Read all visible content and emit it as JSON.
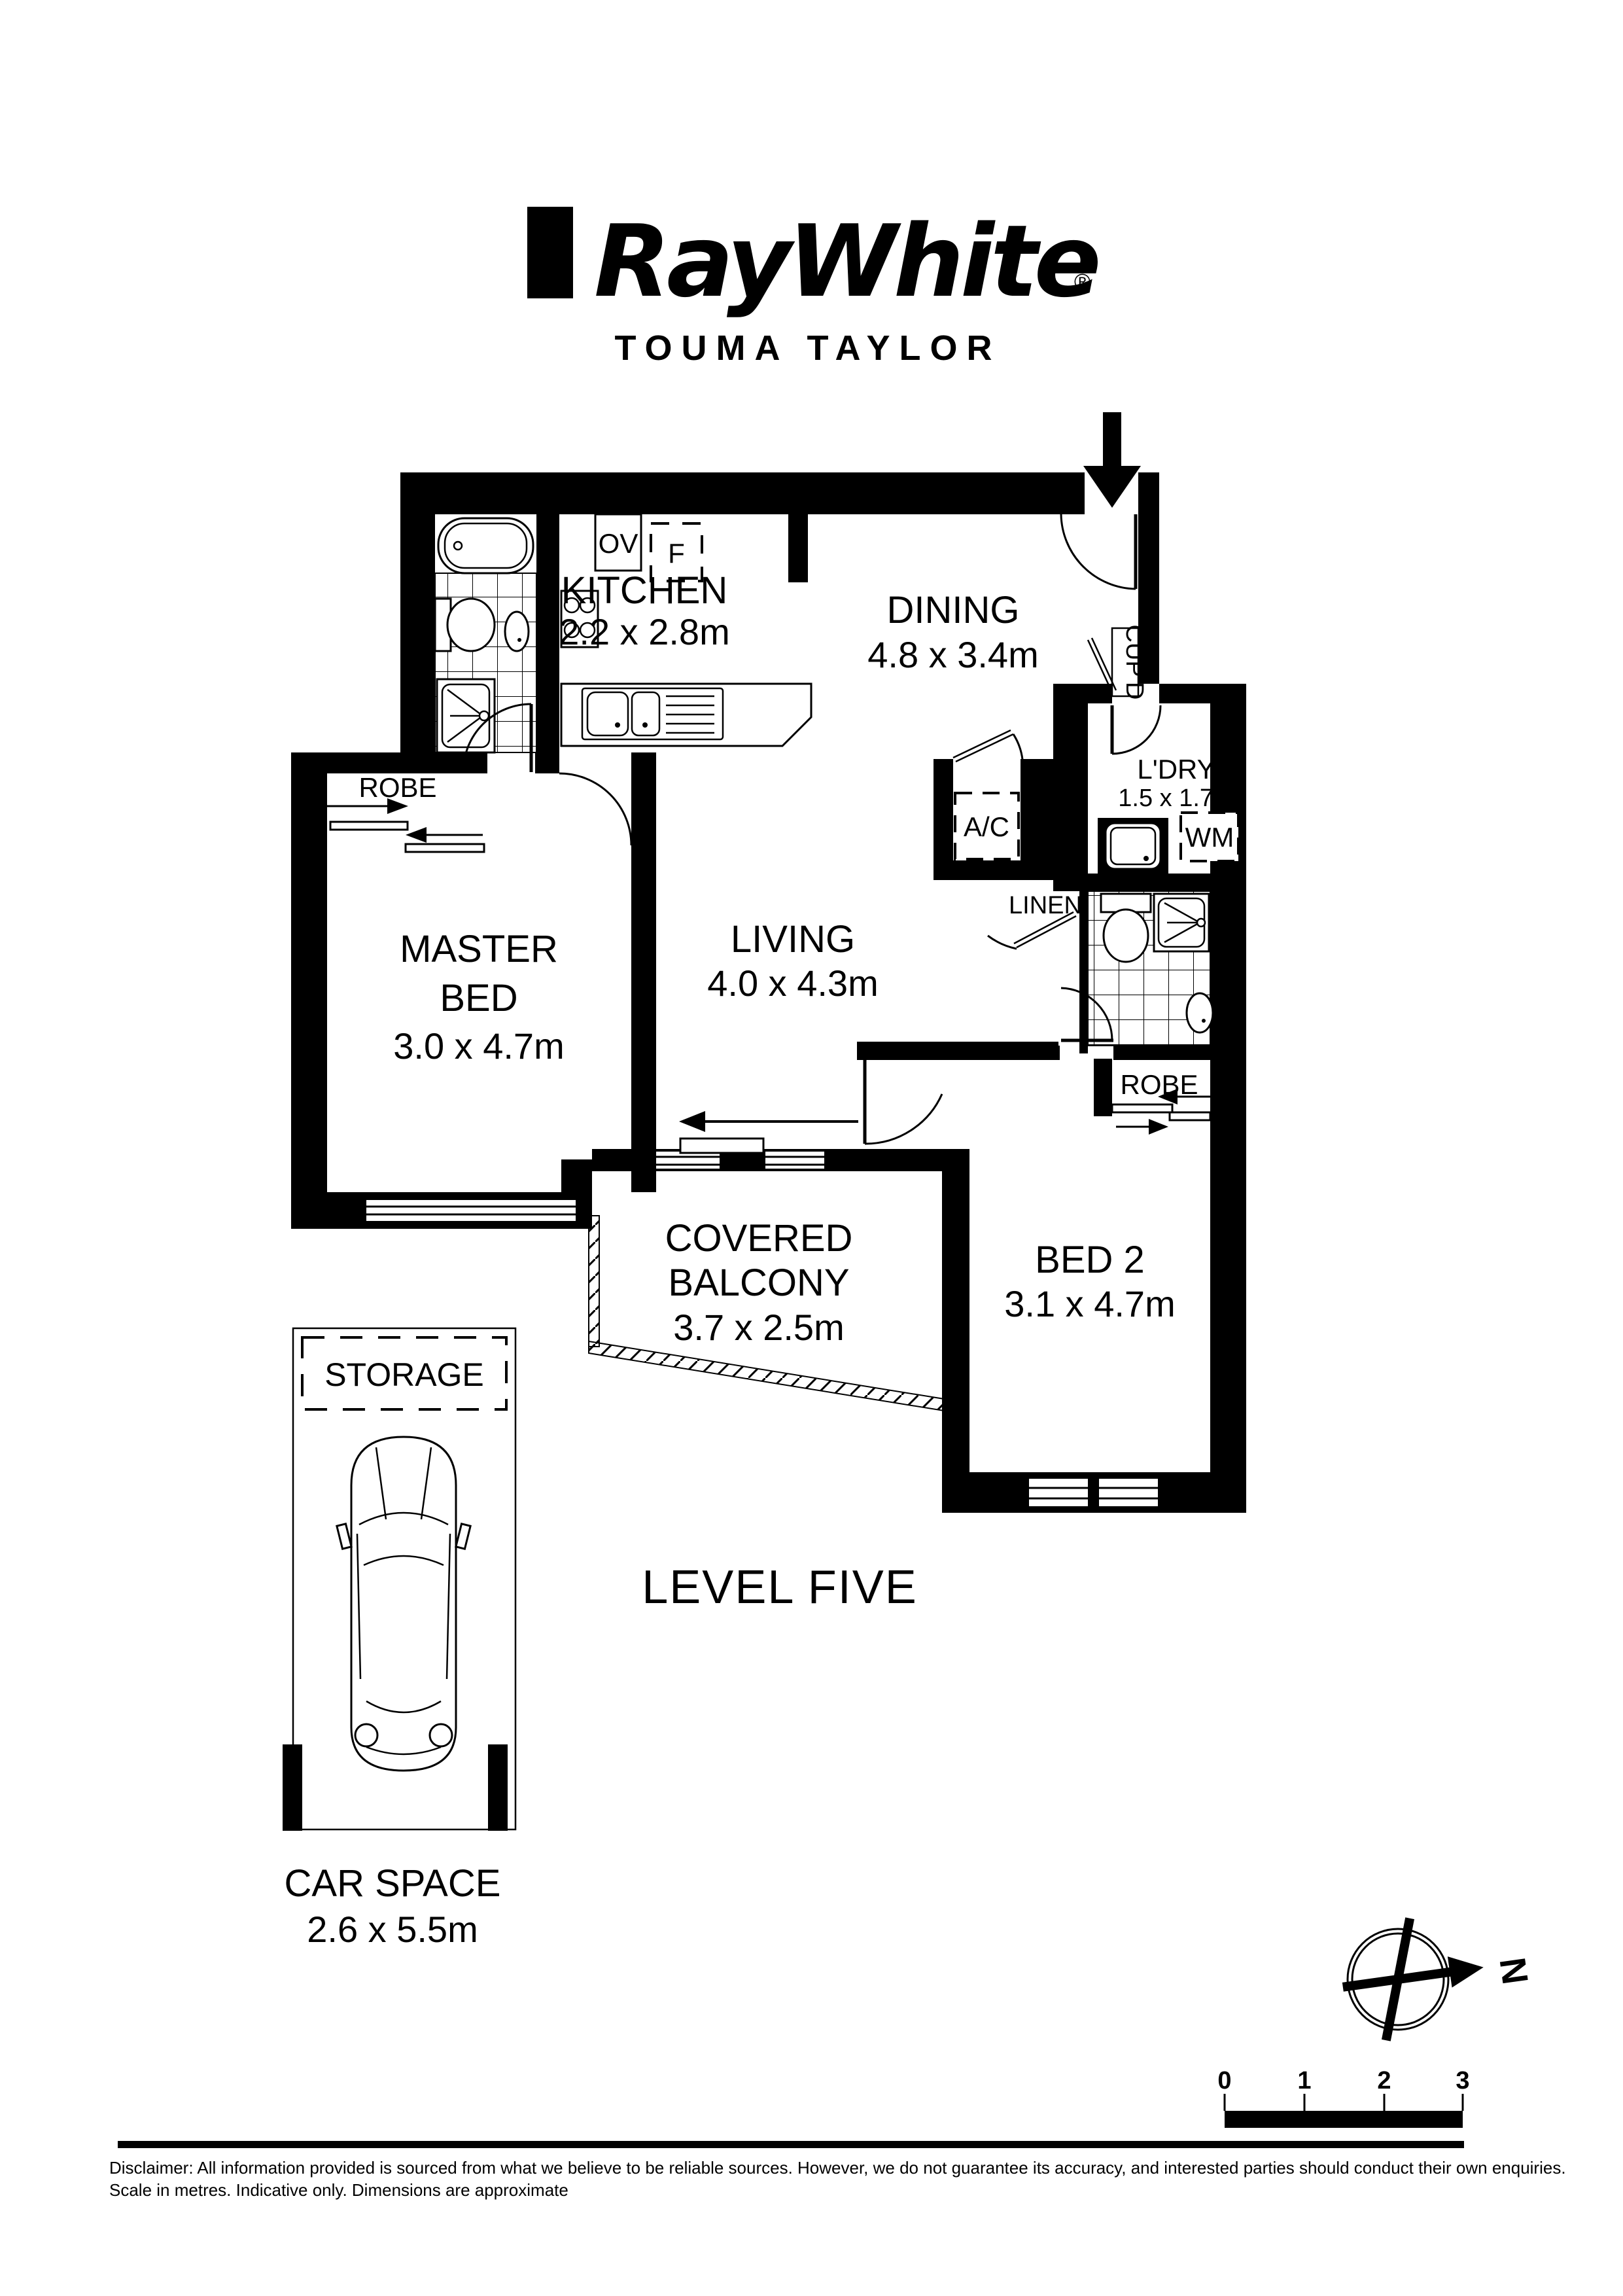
{
  "header": {
    "logo_text": "RayWhite",
    "registered_mark": "®",
    "office_name": "TOUMA TAYLOR"
  },
  "floorplan": {
    "rooms": {
      "kitchen": {
        "name": "KITCHEN",
        "dims": "2.2 x 2.8m"
      },
      "dining": {
        "name": "DINING",
        "dims": "4.8 x 3.4m"
      },
      "living": {
        "name": "LIVING",
        "dims": "4.0 x 4.3m"
      },
      "master_bed": {
        "name_line1": "MASTER",
        "name_line2": "BED",
        "dims": "3.0 x 4.7m"
      },
      "bed2": {
        "name": "BED 2",
        "dims": "3.1 x 4.7m"
      },
      "covered_balcony": {
        "name_line1": "COVERED",
        "name_line2": "BALCONY",
        "dims": "3.7 x 2.5m"
      },
      "laundry": {
        "name": "L'DRY",
        "dims": "1.5 x 1.7m"
      }
    },
    "fixtures": {
      "oven": "OV",
      "fridge": "F",
      "washing_machine": "WM",
      "air_con": "A/C",
      "cupboard": "CUP'D",
      "linen": "LINEN",
      "robe_master": "ROBE",
      "robe_bed2": "ROBE"
    }
  },
  "parking": {
    "storage_label": "STORAGE",
    "car_space_name": "CAR SPACE",
    "car_space_dims": "2.6 x 5.5m"
  },
  "level_label": "LEVEL FIVE",
  "compass": {
    "north_label": "N"
  },
  "scale_bar": {
    "ticks": [
      "0",
      "1",
      "2",
      "3"
    ]
  },
  "footer": {
    "disclaimer_line1": "Disclaimer: All information provided is sourced from what we believe to be reliable sources. However, we do not guarantee  its accuracy, and interested parties should conduct their own enquiries.",
    "disclaimer_line2": "Scale in metres. Indicative only. Dimensions are approximate"
  },
  "colors": {
    "ink": "#000000",
    "paper": "#ffffff"
  }
}
